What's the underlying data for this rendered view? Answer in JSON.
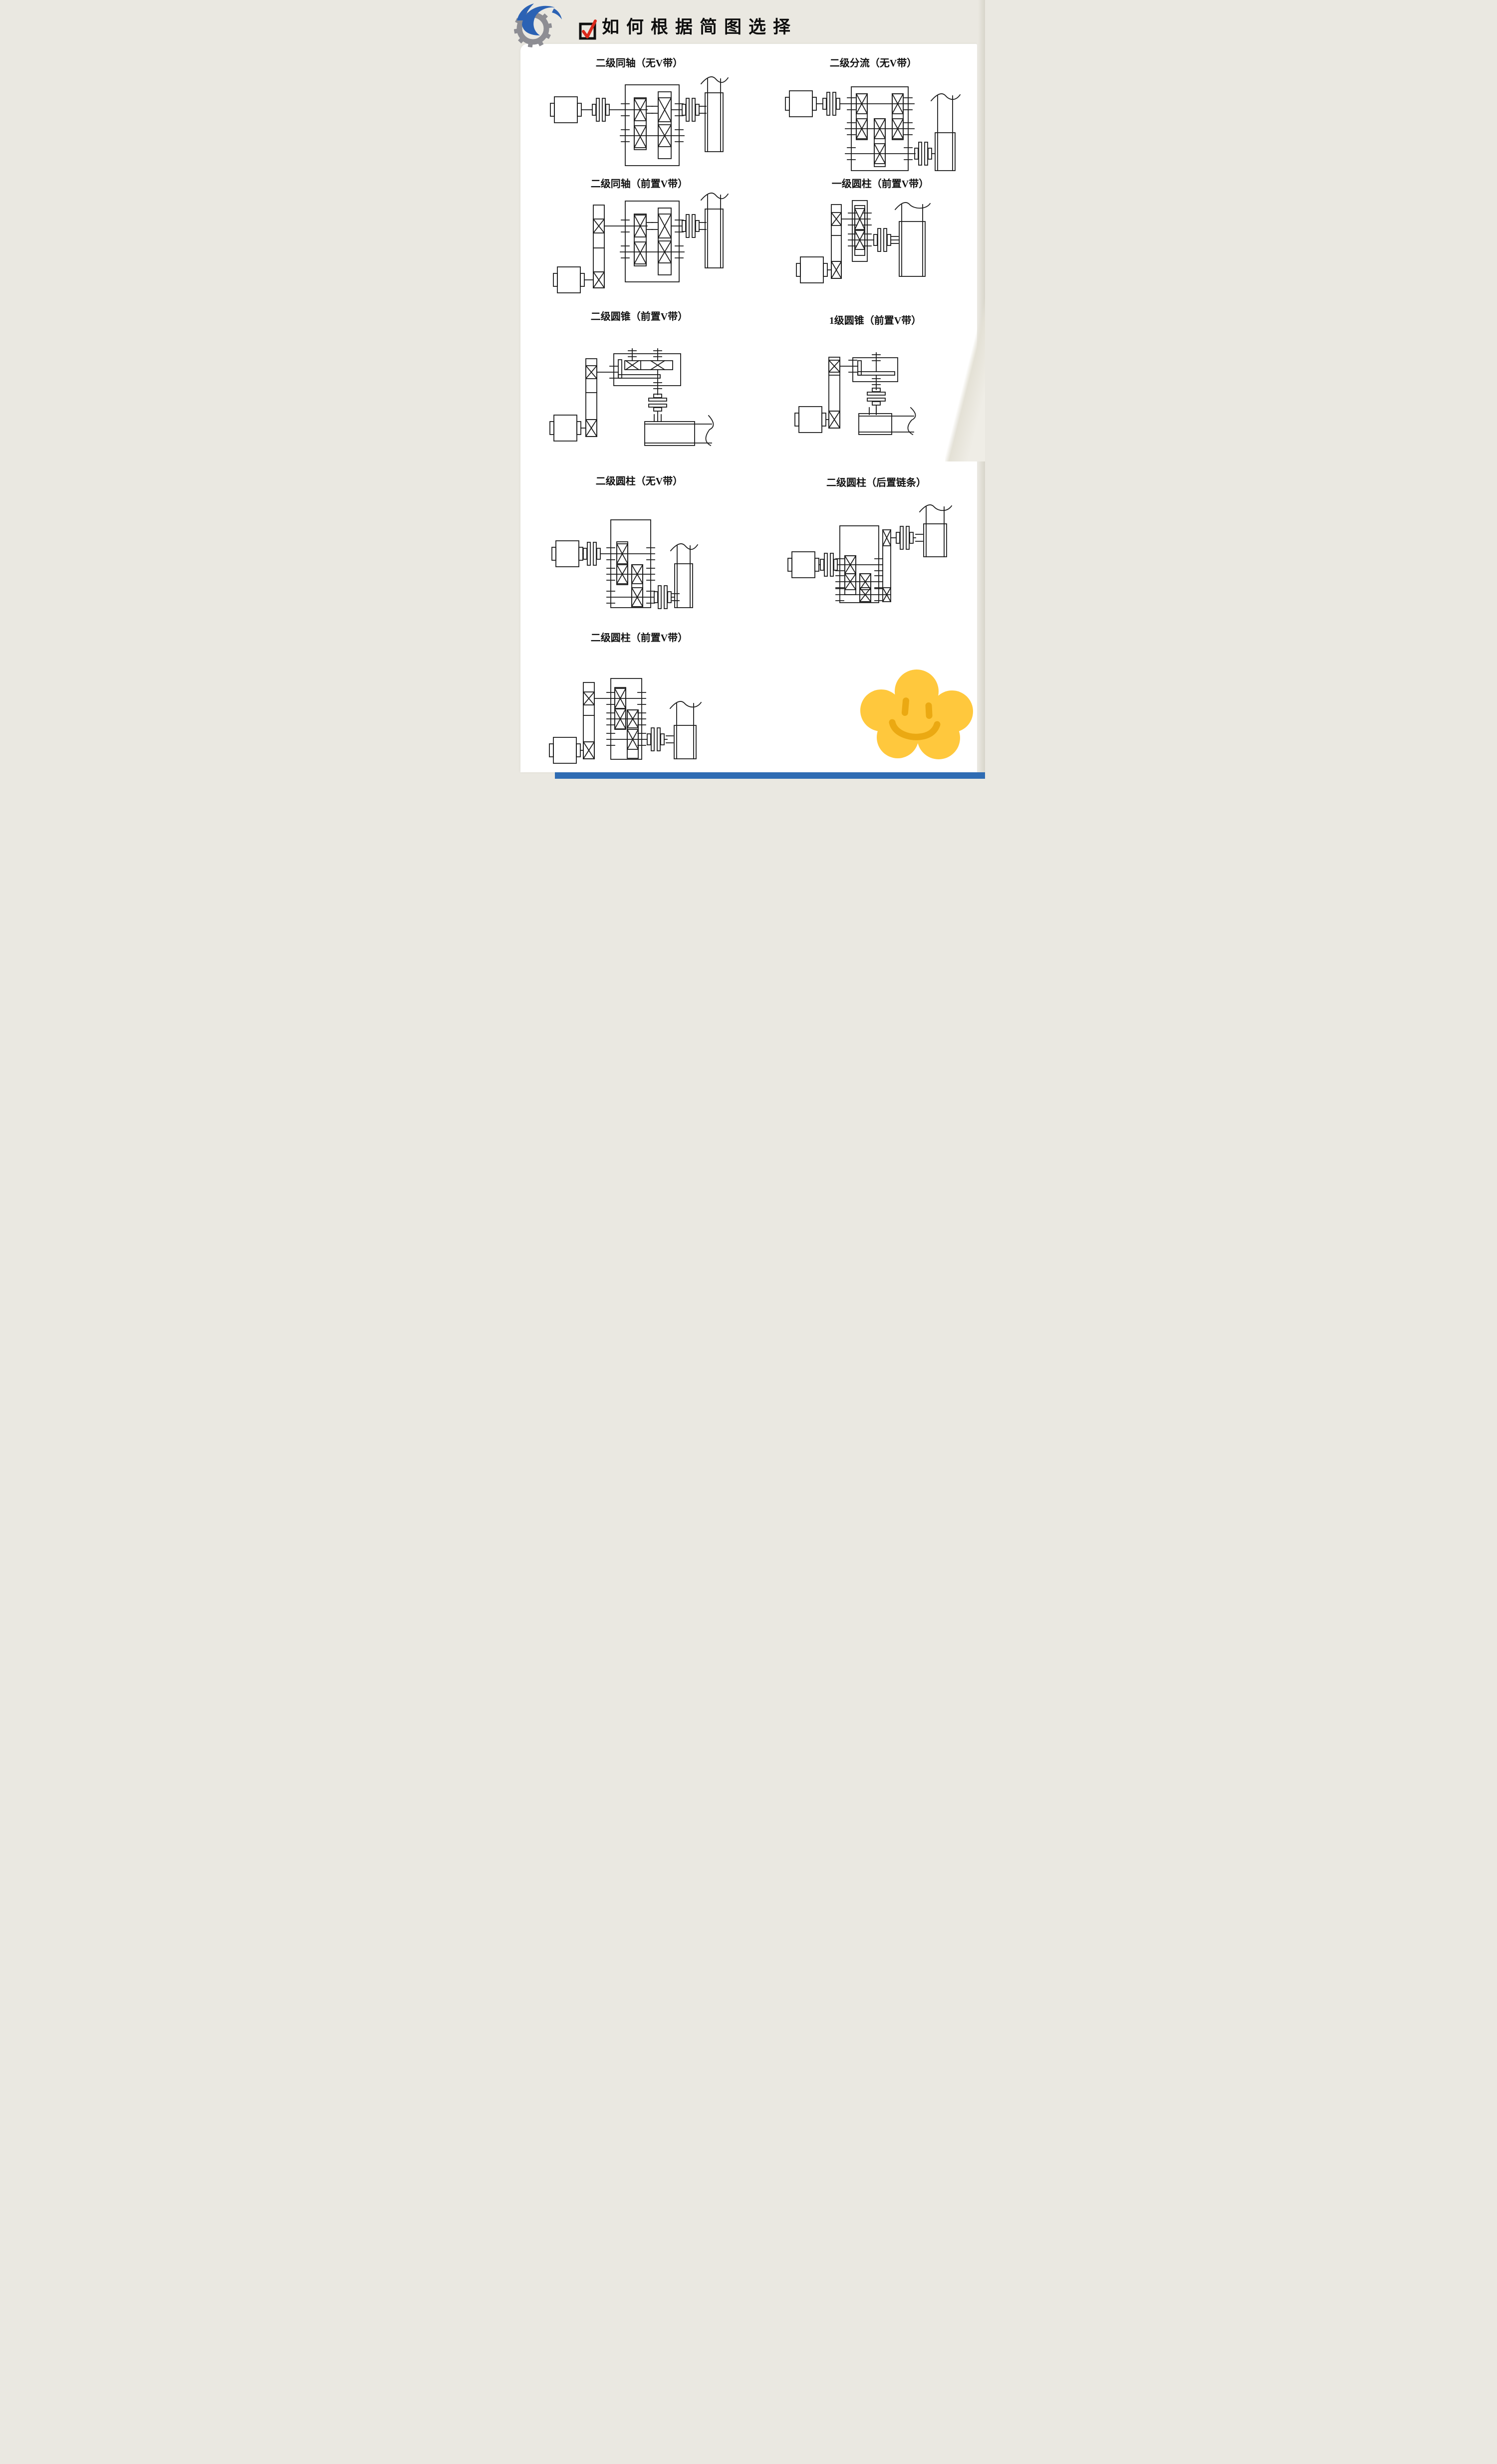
{
  "header": {
    "title": "如何根据简图选择",
    "logo_icon": "gear-swirl-logo",
    "bullet_icon": "red-check-checkbox"
  },
  "diagrams": [
    {
      "label": "二级同轴（无V带）",
      "components": [
        "motor",
        "coupling",
        "coaxial-two-stage-gearbox",
        "coupling",
        "driven-machine"
      ]
    },
    {
      "label": "二级分流（无V带）",
      "components": [
        "motor",
        "coupling",
        "split-two-stage-gearbox",
        "coupling",
        "driven-machine"
      ]
    },
    {
      "label": "二级同轴（前置V带）",
      "components": [
        "motor",
        "v-belt-drive",
        "coaxial-two-stage-gearbox",
        "coupling",
        "driven-machine"
      ]
    },
    {
      "label": "一级圆柱（前置V带）",
      "components": [
        "motor",
        "v-belt-drive",
        "single-stage-gearbox",
        "coupling",
        "driven-machine"
      ]
    },
    {
      "label": "二级圆锥（前置V带）",
      "components": [
        "motor",
        "v-belt-drive",
        "bevel-spur-two-stage-gearbox",
        "coupling",
        "driven-machine"
      ]
    },
    {
      "label": "1级圆锥（前置V带）",
      "components": [
        "motor",
        "v-belt-drive",
        "bevel-single-stage-gearbox",
        "coupling",
        "driven-machine"
      ]
    },
    {
      "label": "二级圆柱（无V带）",
      "components": [
        "motor",
        "coupling",
        "expanded-two-stage-gearbox",
        "coupling",
        "driven-machine"
      ]
    },
    {
      "label": "二级圆柱（后置链条）",
      "components": [
        "motor",
        "coupling",
        "expanded-two-stage-gearbox",
        "chain-drive",
        "coupling",
        "driven-machine"
      ]
    },
    {
      "label": "二级圆柱（前置V带）",
      "components": [
        "motor",
        "v-belt-drive",
        "expanded-two-stage-gearbox",
        "coupling",
        "driven-machine"
      ]
    }
  ],
  "decoration": {
    "flower_doodle": {
      "name": "smiley-flower",
      "petal_color": "#FFC83D",
      "face_color": "#EBA912"
    }
  },
  "colors": {
    "background": "#EAE8E1",
    "panel": "#FFFFFF",
    "schematic_line": "#1C1C1C",
    "accent_bar": "#2F6CB3",
    "logo_blue": "#2B62B4",
    "logo_gray": "#8D8D93",
    "check_red": "#DA2A1C"
  }
}
